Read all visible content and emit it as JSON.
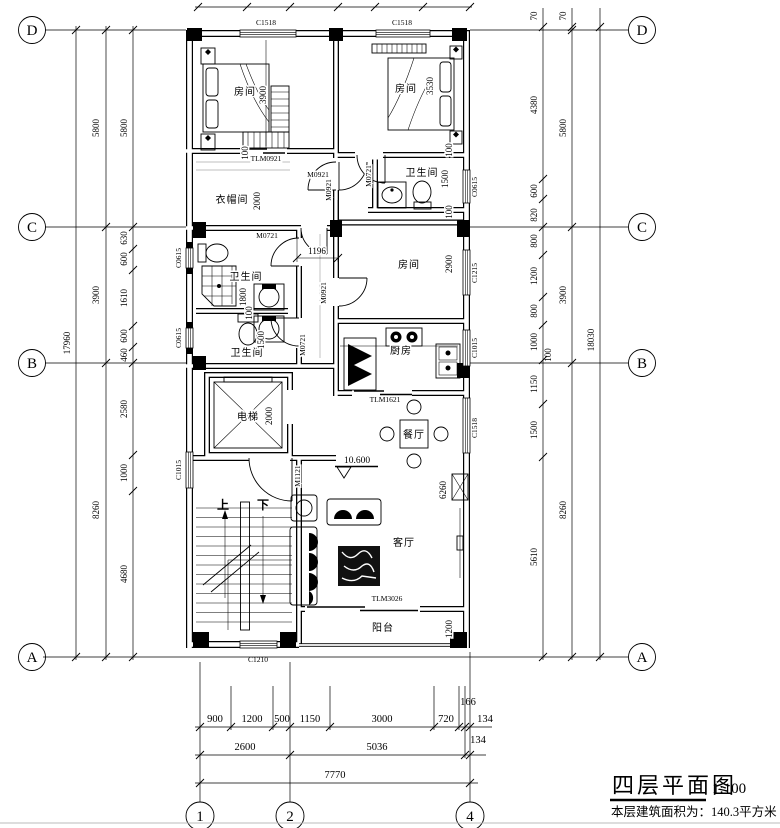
{
  "colors": {
    "ink": "#000000",
    "paper": "#ffffff"
  },
  "title_block": {
    "title": "四层平面图",
    "scale": "1:100",
    "area_note": "本层建筑面积为：140.3平方米"
  },
  "grid_labels": {
    "d": "D",
    "c": "C",
    "b": "B",
    "a": "A",
    "g1": "1",
    "g2": "2",
    "g4": "4"
  },
  "room_labels": {
    "bedroom": "房间",
    "cloakroom": "衣帽间",
    "bathroom": "卫生间",
    "elevator": "电梯",
    "kitchen": "厨房",
    "dining": "餐厅",
    "living": "客厅",
    "balcony": "阳台",
    "stairs_up": "上",
    "stairs_down": "下"
  },
  "level_marker": "10.600",
  "opening_codes": {
    "c1518": "C1518",
    "c0615": "C0615",
    "c1015": "C1015",
    "c1215": "C1215",
    "c1210": "C1210",
    "tlm0921": "TLM0921",
    "tlm1621": "TLM1621",
    "tlm3026": "TLM3026",
    "m0921": "M0921",
    "m0721": "M0721",
    "m1121": "M1121"
  },
  "dimensions": {
    "left_outer": "17960",
    "left_mid": [
      "5800",
      "3900",
      "8260"
    ],
    "left_inner": [
      "5800",
      "630",
      "600",
      "1610",
      "600",
      "460",
      "2580",
      "1000",
      "4680"
    ],
    "right_outer": "18030",
    "right_mid": [
      "70",
      "5800",
      "3900",
      "8260"
    ],
    "right_inner": [
      "70",
      "4380",
      "600",
      "820",
      "800",
      "1200",
      "800",
      "1000",
      "100",
      "1150",
      "1500",
      "5610"
    ],
    "bottom_row1": [
      "900",
      "1200",
      "500",
      "1150",
      "3000",
      "720",
      "166",
      "134"
    ],
    "bottom_row2": [
      "2600",
      "5036",
      "134"
    ],
    "bottom_total": "7770",
    "room_dims": {
      "bed1": "3900",
      "cloak": "2000",
      "bath1": "1800",
      "bath2": "1500",
      "elevator": "2000",
      "bed2": "3530",
      "bath3": "1500",
      "bed3": "2900",
      "hall": "1196",
      "living": "6260",
      "balcony": "1200",
      "gap": "100"
    }
  }
}
